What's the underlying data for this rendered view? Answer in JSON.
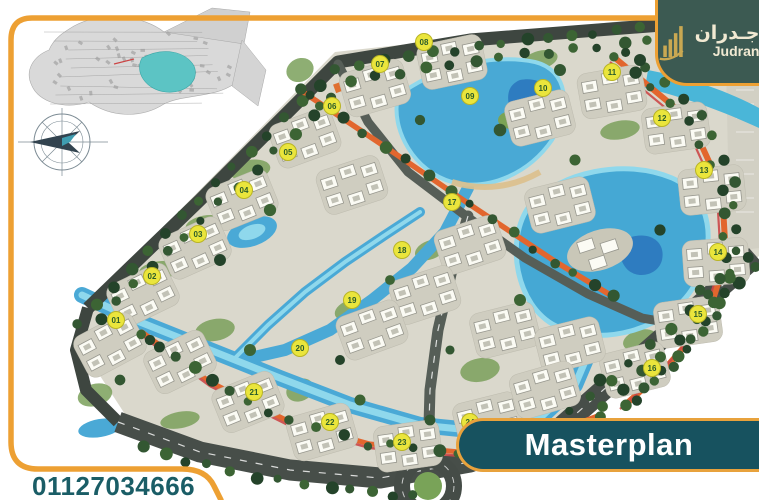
{
  "branding": {
    "logo_arabic": "جـدران",
    "logo_latin": "Judran",
    "logo_bg_color": "#3C5A52",
    "logo_gold_color": "#C9A852",
    "logo_text_color": "#F1E9D2"
  },
  "frame_color": "#EDA033",
  "banner": {
    "label": "Masterplan",
    "bg_color": "#17525F",
    "border_color": "#E8A23C",
    "text_color": "#FFFFFF"
  },
  "contact": {
    "phone": "01127034666",
    "color": "#1A5D66"
  },
  "masterplan": {
    "ground_color": "#DAD8CC",
    "road_color": "#3E4640",
    "highway_color": "#474E49",
    "water_color": "#4AA9D6",
    "water_light_color": "#8FD8EC",
    "water_deep_color": "#2E7CC0",
    "tree_colors": [
      "#24432A",
      "#335732",
      "#3C6434"
    ],
    "lawn_color": "#7AA05B",
    "promenade_color": "#E2662E",
    "track_color": "#CB4848",
    "building_color": "#FBFBF4",
    "badge_fill": "#EAE53C",
    "badge_text_color": "#2A5C2B",
    "badges": [
      {
        "label": "01",
        "x": 116,
        "y": 320
      },
      {
        "label": "02",
        "x": 152,
        "y": 276
      },
      {
        "label": "03",
        "x": 198,
        "y": 234
      },
      {
        "label": "04",
        "x": 244,
        "y": 190
      },
      {
        "label": "05",
        "x": 288,
        "y": 152
      },
      {
        "label": "06",
        "x": 332,
        "y": 106
      },
      {
        "label": "07",
        "x": 380,
        "y": 64
      },
      {
        "label": "08",
        "x": 424,
        "y": 42
      },
      {
        "label": "09",
        "x": 470,
        "y": 96
      },
      {
        "label": "10",
        "x": 543,
        "y": 88
      },
      {
        "label": "11",
        "x": 612,
        "y": 72
      },
      {
        "label": "12",
        "x": 662,
        "y": 118
      },
      {
        "label": "13",
        "x": 704,
        "y": 170
      },
      {
        "label": "14",
        "x": 718,
        "y": 252
      },
      {
        "label": "15",
        "x": 698,
        "y": 314
      },
      {
        "label": "16",
        "x": 652,
        "y": 368
      },
      {
        "label": "17",
        "x": 452,
        "y": 202
      },
      {
        "label": "18",
        "x": 402,
        "y": 250
      },
      {
        "label": "19",
        "x": 352,
        "y": 300
      },
      {
        "label": "20",
        "x": 300,
        "y": 348
      },
      {
        "label": "21",
        "x": 254,
        "y": 392
      },
      {
        "label": "22",
        "x": 330,
        "y": 422
      },
      {
        "label": "23",
        "x": 402,
        "y": 442
      },
      {
        "label": "24",
        "x": 470,
        "y": 422
      }
    ]
  },
  "inset_map": {
    "lake_color": "#5CC4C4",
    "line_color": "#A8A8A8"
  },
  "compass": {
    "color": "#7C8B94",
    "needle_color": "#32434F",
    "accent_color": "#3F9DB1"
  }
}
